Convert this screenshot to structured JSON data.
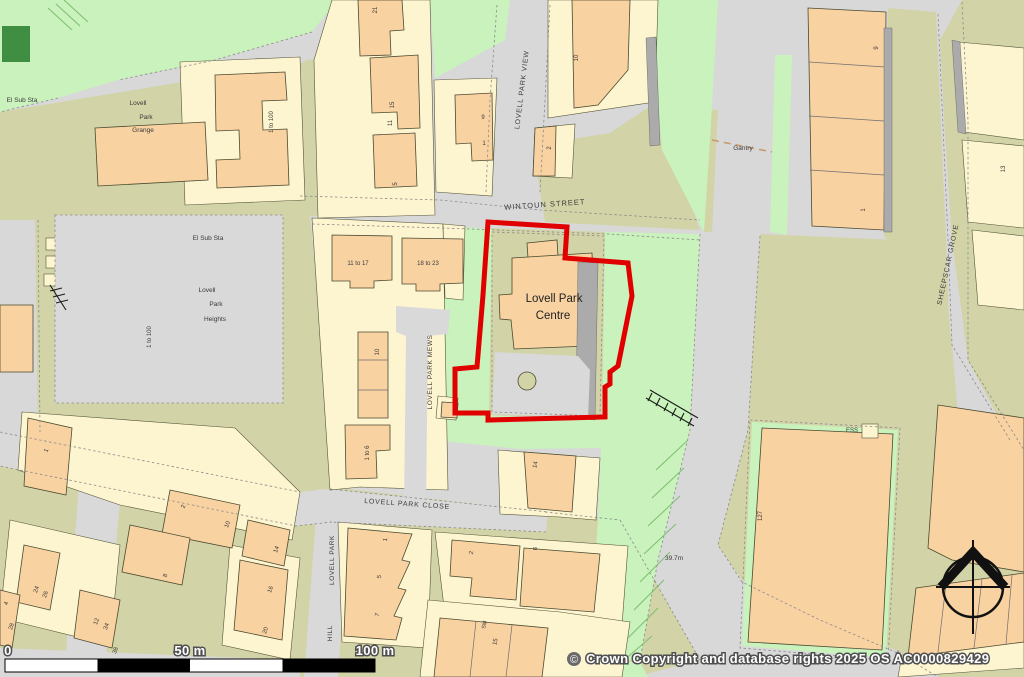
{
  "map": {
    "colors": {
      "boundary": "#e10000",
      "road": "#d8d8d8",
      "green": "#c9f2bc",
      "dgreen": "#3f8e41",
      "khaki": "#d2d3a6",
      "building_peach": "#f9d2a2",
      "building_yellow": "#fdf5d0"
    },
    "site": {
      "name": "Lovell Park Centre"
    },
    "icons": {
      "north_arrow": "compass-rose-icon",
      "copyright_symbol_icon": "copyright-circle-icon"
    },
    "scale_bar": {
      "zero": "0",
      "fifty": "50 m",
      "hundred": "100 m"
    },
    "copyright": {
      "symbol": "©",
      "text": "Crown Copyright and database rights 2025 OS AC0000829429"
    },
    "labels": [
      {
        "text": "WINTOUN STREET",
        "x": 545,
        "y": 207,
        "rot": -4,
        "size": 7.5,
        "ls": 1,
        "name": "street-label-wintoun-street"
      },
      {
        "text": "LOVELL PARK VIEW",
        "x": 524,
        "y": 90,
        "rot": -83,
        "size": 7,
        "ls": 0.8,
        "name": "street-label-lovell-park-view"
      },
      {
        "text": "LOVELL PARK MEWS",
        "x": 432,
        "y": 372,
        "rot": -90,
        "size": 6.5,
        "ls": 0.6,
        "name": "street-label-lovell-park-mews"
      },
      {
        "text": "LOVELL PARK CLOSE",
        "x": 407,
        "y": 506,
        "rot": 4,
        "size": 7,
        "ls": 0.8,
        "name": "street-label-lovell-park-close"
      },
      {
        "text": "LOVELL PARK",
        "x": 334,
        "y": 560,
        "rot": -90,
        "size": 6.5,
        "ls": 0.6,
        "name": "street-label-lovell-park-hill-1"
      },
      {
        "text": "HILL",
        "x": 332,
        "y": 633,
        "rot": -90,
        "size": 6.5,
        "ls": 0.6,
        "name": "street-label-lovell-park-hill-2"
      },
      {
        "text": "SHEEPSCAR GROVE",
        "x": 950,
        "y": 265,
        "rot": -78,
        "size": 7,
        "ls": 0.8,
        "name": "street-label-sheepscar-grove"
      },
      {
        "text": "El Sub Sta",
        "x": 22,
        "y": 102,
        "size": 6.5,
        "name": "place-label-el-sub-sta-1"
      },
      {
        "text": "Lovell",
        "x": 138,
        "y": 105,
        "size": 6.5,
        "name": "place-label-grange-1"
      },
      {
        "text": "Park",
        "x": 146,
        "y": 119,
        "size": 6.5,
        "name": "place-label-grange-2"
      },
      {
        "text": "Grange",
        "x": 143,
        "y": 132,
        "size": 6.5,
        "name": "place-label-grange-3"
      },
      {
        "text": "El Sub Sta",
        "x": 208,
        "y": 240,
        "size": 6.5,
        "name": "place-label-el-sub-sta-2"
      },
      {
        "text": "Lovell",
        "x": 207,
        "y": 292,
        "size": 6.5,
        "name": "place-label-heights-1"
      },
      {
        "text": "Park",
        "x": 216,
        "y": 306,
        "size": 6.5,
        "name": "place-label-heights-2"
      },
      {
        "text": "Heights",
        "x": 215,
        "y": 321,
        "size": 6.5,
        "name": "place-label-heights-3"
      },
      {
        "text": "Gantry",
        "x": 743,
        "y": 150,
        "size": 6.5,
        "name": "place-label-gantry"
      },
      {
        "text": "ESS",
        "x": 852,
        "y": 432,
        "size": 6,
        "name": "place-label-ess"
      },
      {
        "text": "39.7m",
        "x": 674,
        "y": 560,
        "size": 6.5,
        "name": "spot-height-label"
      },
      {
        "text": "Lovell Park",
        "x": 554,
        "y": 302,
        "size": 11.5,
        "fill": "#1f1f1f",
        "name": "site-building-label-line1"
      },
      {
        "text": "Centre",
        "x": 553,
        "y": 319,
        "size": 11.5,
        "fill": "#1f1f1f",
        "name": "site-building-label-line2"
      },
      {
        "text": "1 to 100",
        "x": 273,
        "y": 122,
        "rot": -90,
        "size": 6,
        "name": "building-number"
      },
      {
        "text": "1 to 100",
        "x": 151,
        "y": 337,
        "rot": -90,
        "size": 6,
        "name": "building-number"
      },
      {
        "text": "11 to 17",
        "x": 358,
        "y": 265,
        "size": 6,
        "name": "building-number"
      },
      {
        "text": "18 to 23",
        "x": 428,
        "y": 265,
        "size": 6,
        "name": "building-number"
      },
      {
        "text": "10",
        "x": 379,
        "y": 352,
        "rot": -90,
        "size": 6,
        "name": "building-number"
      },
      {
        "text": "1 to 6",
        "x": 369,
        "y": 453,
        "rot": -90,
        "size": 6,
        "name": "building-number"
      },
      {
        "text": "21",
        "x": 377,
        "y": 10,
        "rot": -90,
        "size": 6,
        "name": "building-number"
      },
      {
        "text": "15",
        "x": 394,
        "y": 105,
        "rot": -90,
        "size": 6,
        "name": "building-number"
      },
      {
        "text": "11",
        "x": 392,
        "y": 123,
        "rot": -90,
        "size": 6,
        "name": "building-number"
      },
      {
        "text": "5",
        "x": 397,
        "y": 184,
        "rot": -90,
        "size": 6,
        "name": "building-number"
      },
      {
        "text": "9",
        "x": 483,
        "y": 119,
        "size": 6,
        "name": "building-number"
      },
      {
        "text": "1",
        "x": 484,
        "y": 145,
        "size": 6,
        "name": "building-number"
      },
      {
        "text": "10",
        "x": 578,
        "y": 58,
        "rot": -90,
        "size": 6,
        "name": "building-number"
      },
      {
        "text": "2",
        "x": 551,
        "y": 148,
        "rot": -90,
        "size": 6,
        "name": "building-number"
      },
      {
        "text": "9",
        "x": 878,
        "y": 48,
        "rot": -90,
        "size": 6,
        "name": "building-number"
      },
      {
        "text": "1",
        "x": 865,
        "y": 210,
        "rot": -90,
        "size": 6,
        "name": "building-number"
      },
      {
        "text": "13",
        "x": 1005,
        "y": 169,
        "rot": -90,
        "size": 6,
        "name": "building-number"
      },
      {
        "text": "127",
        "x": 762,
        "y": 516,
        "rot": -90,
        "size": 6,
        "name": "building-number"
      },
      {
        "text": "14",
        "x": 537,
        "y": 465,
        "rot": -80,
        "size": 6,
        "name": "building-number"
      },
      {
        "text": "2",
        "x": 473,
        "y": 553,
        "rot": -80,
        "size": 6,
        "name": "building-number"
      },
      {
        "text": "6",
        "x": 537,
        "y": 549,
        "rot": -80,
        "size": 6,
        "name": "building-number"
      },
      {
        "text": "1",
        "x": 387,
        "y": 540,
        "rot": -80,
        "size": 6,
        "name": "building-number"
      },
      {
        "text": "5",
        "x": 381,
        "y": 577,
        "rot": -80,
        "size": 6,
        "name": "building-number"
      },
      {
        "text": "7",
        "x": 379,
        "y": 615,
        "rot": -80,
        "size": 6,
        "name": "building-number"
      },
      {
        "text": "SM",
        "x": 486,
        "y": 625,
        "rot": -80,
        "size": 5.5,
        "name": "building-number"
      },
      {
        "text": "15",
        "x": 497,
        "y": 642,
        "rot": -80,
        "size": 6,
        "name": "building-number"
      },
      {
        "text": "1",
        "x": 48,
        "y": 451,
        "rot": -70,
        "size": 6,
        "name": "building-number"
      },
      {
        "text": "2",
        "x": 185,
        "y": 507,
        "rot": -70,
        "size": 6,
        "name": "building-number"
      },
      {
        "text": "10",
        "x": 229,
        "y": 525,
        "rot": -70,
        "size": 6,
        "name": "building-number"
      },
      {
        "text": "14",
        "x": 278,
        "y": 550,
        "rot": -70,
        "size": 6,
        "name": "building-number"
      },
      {
        "text": "8",
        "x": 167,
        "y": 576,
        "rot": -70,
        "size": 6,
        "name": "building-number"
      },
      {
        "text": "24",
        "x": 38,
        "y": 590,
        "rot": -70,
        "size": 6,
        "name": "building-number"
      },
      {
        "text": "26",
        "x": 47,
        "y": 595,
        "rot": -70,
        "size": 6,
        "name": "building-number"
      },
      {
        "text": "4",
        "x": 8,
        "y": 604,
        "rot": -70,
        "size": 6,
        "name": "building-number"
      },
      {
        "text": "12",
        "x": 98,
        "y": 622,
        "rot": -70,
        "size": 6,
        "name": "building-number"
      },
      {
        "text": "34",
        "x": 108,
        "y": 627,
        "rot": -70,
        "size": 6,
        "name": "building-number"
      },
      {
        "text": "38",
        "x": 117,
        "y": 651,
        "rot": -70,
        "size": 6,
        "name": "building-number"
      },
      {
        "text": "28",
        "x": 13,
        "y": 627,
        "rot": -70,
        "size": 6,
        "name": "building-number"
      },
      {
        "text": "16",
        "x": 272,
        "y": 590,
        "rot": -70,
        "size": 6,
        "name": "building-number"
      },
      {
        "text": "20",
        "x": 267,
        "y": 631,
        "rot": -70,
        "size": 6,
        "name": "building-number"
      }
    ]
  }
}
